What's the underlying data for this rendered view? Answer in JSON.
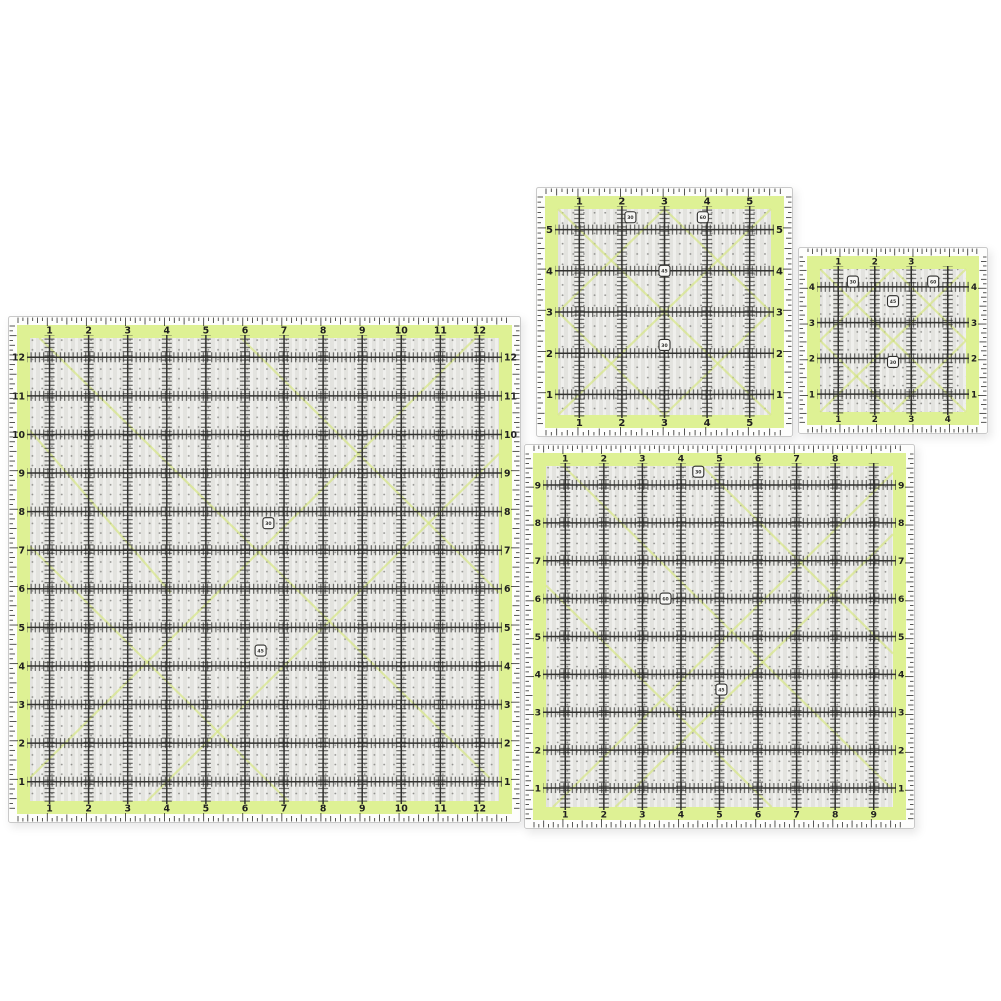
{
  "palette": {
    "background": "#ffffff",
    "band_green": "#def194",
    "grid_dark": "#2f2f2d",
    "inner_bg": "#efefec",
    "stripe": "#e2e2de",
    "dot": "#8f8f8c",
    "diagonal_green": "#d6e77f",
    "tick": "#2f2f2d",
    "number": "#1f1f1f",
    "edge_bg": "#fdfdfc",
    "border": "#c9c9c9",
    "mark_fill": "#f7f7f5"
  },
  "rulers": [
    {
      "name": "quilting-ruler-12-inch-square",
      "units": 12,
      "top_labels": [
        "1",
        "2",
        "3",
        "4",
        "5",
        "6",
        "7",
        "8",
        "9",
        "10",
        "11",
        "12"
      ],
      "bottom_labels": [
        "1",
        "2",
        "3",
        "4",
        "5",
        "6",
        "7",
        "8",
        "9",
        "10",
        "11",
        "12"
      ],
      "left_labels": [
        "12",
        "11",
        "10",
        "9",
        "8",
        "7",
        "6",
        "5",
        "4",
        "3",
        "2",
        "1"
      ],
      "right_labels": [
        "12",
        "11",
        "10",
        "9",
        "8",
        "7",
        "6",
        "5",
        "4",
        "3",
        "2",
        "1"
      ],
      "marks": [
        {
          "u": 6.6,
          "v": 5.3,
          "label": "30"
        },
        {
          "u": 6.4,
          "v": 8.6,
          "label": "45"
        }
      ],
      "diagonals": [
        [
          0.02,
          0.0,
          0.98,
          0.95
        ],
        [
          0.0,
          0.45,
          0.55,
          1.0
        ],
        [
          0.45,
          0.0,
          1.0,
          0.55
        ],
        [
          0.0,
          0.95,
          0.95,
          0.0
        ],
        [
          0.25,
          1.0,
          1.0,
          0.25
        ],
        [
          0.0,
          0.2,
          0.3,
          0.55
        ]
      ]
    },
    {
      "name": "quilting-ruler-6-inch-square",
      "units": 5,
      "top_labels": [
        "1",
        "2",
        "3",
        "4",
        "5"
      ],
      "bottom_labels": [
        "1",
        "2",
        "3",
        "4",
        "5"
      ],
      "left_labels": [
        "5",
        "4",
        "3",
        "2",
        "1"
      ],
      "right_labels": [
        "5",
        "4",
        "3",
        "2",
        "1"
      ],
      "marks": [
        {
          "u": 2.2,
          "v": 0.7,
          "label": "30"
        },
        {
          "u": 3.9,
          "v": 0.7,
          "label": "60"
        },
        {
          "u": 3.0,
          "v": 2.0,
          "label": "45"
        },
        {
          "u": 3.0,
          "v": 3.8,
          "label": "30"
        }
      ],
      "diagonals": [
        [
          0,
          0,
          1,
          1
        ],
        [
          1,
          0,
          0,
          1
        ],
        [
          0.5,
          0,
          1,
          0.5
        ],
        [
          0.5,
          0,
          0,
          0.5
        ],
        [
          0,
          0.5,
          0.5,
          1
        ],
        [
          1,
          0.5,
          0.5,
          1
        ]
      ]
    },
    {
      "name": "quilting-ruler-4-5-inch-square",
      "units": 4,
      "top_labels": [
        "1",
        "2",
        "3"
      ],
      "bottom_labels": [
        "1",
        "2",
        "3",
        "4"
      ],
      "left_labels": [
        "4",
        "3",
        "2",
        "1"
      ],
      "right_labels": [
        "4",
        "3",
        "2",
        "1"
      ],
      "marks": [
        {
          "u": 1.4,
          "v": 0.85,
          "label": "30"
        },
        {
          "u": 3.6,
          "v": 0.85,
          "label": "60"
        },
        {
          "u": 2.5,
          "v": 1.4,
          "label": "45"
        },
        {
          "u": 2.5,
          "v": 3.1,
          "label": "30"
        }
      ],
      "diagonals": [
        [
          0,
          0,
          1,
          1
        ],
        [
          1,
          0,
          0,
          1
        ],
        [
          0.5,
          0,
          1,
          0.5
        ],
        [
          0.5,
          0,
          0,
          0.5
        ],
        [
          0,
          0.5,
          0.5,
          1
        ],
        [
          1,
          0.5,
          0.5,
          1
        ]
      ]
    },
    {
      "name": "quilting-ruler-9-5-inch-square",
      "units": 9,
      "top_labels": [
        "1",
        "2",
        "3",
        "4",
        "5",
        "6",
        "7",
        "8"
      ],
      "bottom_labels": [
        "1",
        "2",
        "3",
        "4",
        "5",
        "6",
        "7",
        "8",
        "9"
      ],
      "left_labels": [
        "9",
        "8",
        "7",
        "6",
        "5",
        "4",
        "3",
        "2",
        "1"
      ],
      "right_labels": [
        "9",
        "8",
        "7",
        "6",
        "5",
        "4",
        "3",
        "2",
        "1"
      ],
      "marks": [
        {
          "u": 4.45,
          "v": 0.65,
          "label": "30"
        },
        {
          "u": 5.05,
          "v": 6.4,
          "label": "45"
        },
        {
          "u": 3.6,
          "v": 4.0,
          "label": "60"
        }
      ],
      "diagonals": [
        [
          0.05,
          0.0,
          1.0,
          0.95
        ],
        [
          0.0,
          0.35,
          0.65,
          1.0
        ],
        [
          0.45,
          0.0,
          1.0,
          0.55
        ],
        [
          1.0,
          0.02,
          0.02,
          1.0
        ],
        [
          0.2,
          1.0,
          1.0,
          0.2
        ]
      ]
    }
  ]
}
